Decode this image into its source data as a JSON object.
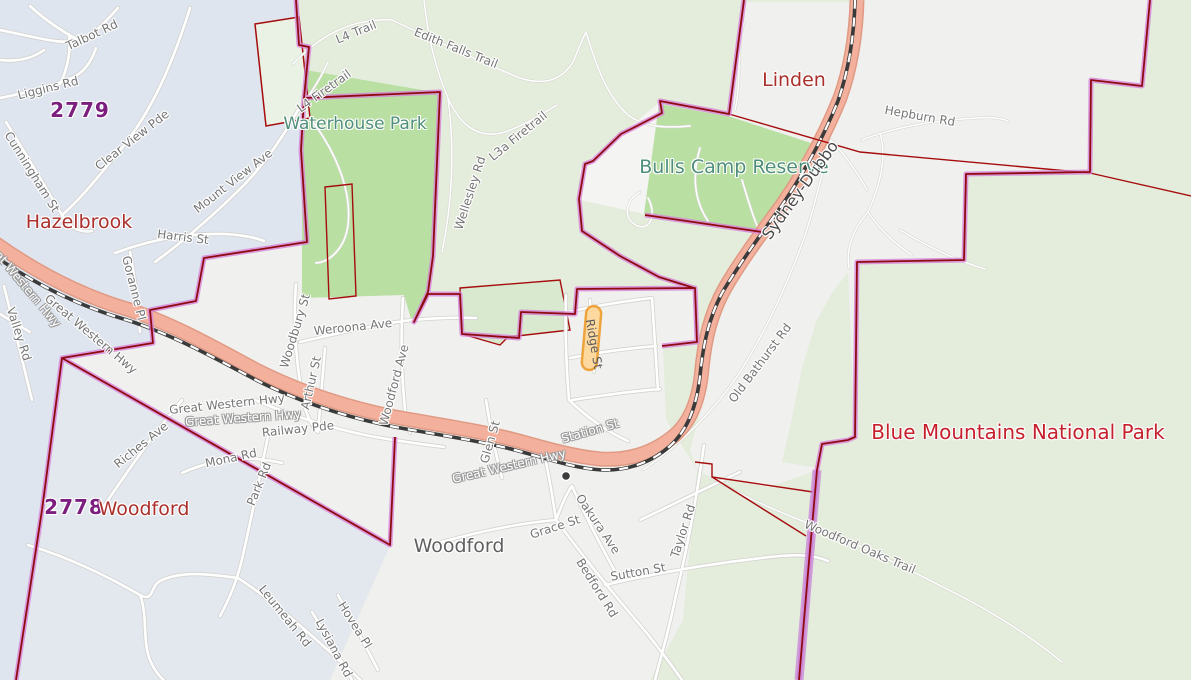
{
  "map": {
    "type": "street-map",
    "region": "Blue Mountains NSW",
    "colors": {
      "bushland_fill": "#e4ecdc",
      "suburb_fill": "#f0f0ee",
      "hazelbrook_fill": "#dfe5ee",
      "park_fill": "#b9dfa2",
      "reserve_fill": "#d8e9cf",
      "parcel_fill": "#eaf2e6",
      "highway_fill": "#f3b19d",
      "highway_casing": "#e09a84",
      "road_fill": "#ffffff",
      "road_casing": "#d2d2cf",
      "railway_dark": "#3a3a3a",
      "boundary_core": "#8e0b10",
      "boundary_glow": "#d783d8",
      "cadastral_red": "#a50d0d",
      "ridge_highlight_fill": "#fdd9a0",
      "ridge_highlight_stroke": "#eda43c",
      "suburb_label": "#ab2f2b",
      "postcode_label": "#7b1e7e",
      "park_label": "#4f8f7a",
      "national_park_label": "#c5202c",
      "road_label": "#757575"
    },
    "icons": {
      "railway_station": "railway-station-icon"
    }
  },
  "labels": [
    {
      "text": "Talbot Rd",
      "kind": "road"
    },
    {
      "text": "Liggins Rd",
      "kind": "road"
    },
    {
      "text": "2779",
      "kind": "postcode"
    },
    {
      "text": "Cunningham St",
      "kind": "road"
    },
    {
      "text": "Clear View Pde",
      "kind": "road"
    },
    {
      "text": "Hazelbrook",
      "kind": "suburb"
    },
    {
      "text": "Harris St",
      "kind": "road"
    },
    {
      "text": "Mount View Ave",
      "kind": "road"
    },
    {
      "text": "Goranne Pl",
      "kind": "road"
    },
    {
      "text": "Valley Rd",
      "kind": "road"
    },
    {
      "text": "Great Western Hwy",
      "kind": "highway"
    },
    {
      "text": "Great Western Hwy",
      "kind": "road"
    },
    {
      "text": "L4 Trail",
      "kind": "trail"
    },
    {
      "text": "Edith Falls Trail",
      "kind": "trail"
    },
    {
      "text": "L4 Firetrail",
      "kind": "trail"
    },
    {
      "text": "Waterhouse Park",
      "kind": "park"
    },
    {
      "text": "Wellesley Rd",
      "kind": "road"
    },
    {
      "text": "L3a Firetrail",
      "kind": "trail"
    },
    {
      "text": "Linden",
      "kind": "suburb"
    },
    {
      "text": "Bulls Camp Reserve",
      "kind": "park"
    },
    {
      "text": "Sydney-Dubbo",
      "kind": "railway"
    },
    {
      "text": "Hepburn Rd",
      "kind": "road"
    },
    {
      "text": "Blue Mountains National Park",
      "kind": "national-park"
    },
    {
      "text": "2778",
      "kind": "postcode"
    },
    {
      "text": "Woodford",
      "kind": "suburb"
    },
    {
      "text": "Woodford",
      "kind": "locality"
    },
    {
      "text": "Woodbury St",
      "kind": "road"
    },
    {
      "text": "Weroona Ave",
      "kind": "road"
    },
    {
      "text": "Arthur St",
      "kind": "road"
    },
    {
      "text": "Woodford Ave",
      "kind": "road"
    },
    {
      "text": "Railway Pde",
      "kind": "road"
    },
    {
      "text": "Great Western Hwy",
      "kind": "road"
    },
    {
      "text": "Great Western Hwy",
      "kind": "highway"
    },
    {
      "text": "Great Western Hwy",
      "kind": "highway"
    },
    {
      "text": "Station St",
      "kind": "highway"
    },
    {
      "text": "Ridge St",
      "kind": "highlighted-road"
    },
    {
      "text": "Glen St",
      "kind": "road"
    },
    {
      "text": "Old Bathurst Rd",
      "kind": "road"
    },
    {
      "text": "Oakura Ave",
      "kind": "road"
    },
    {
      "text": "Grace St",
      "kind": "road"
    },
    {
      "text": "Sutton St",
      "kind": "road"
    },
    {
      "text": "Bedford Rd",
      "kind": "road"
    },
    {
      "text": "Taylor Rd",
      "kind": "road"
    },
    {
      "text": "Leumeah Rd",
      "kind": "road"
    },
    {
      "text": "Hovea Pl",
      "kind": "road"
    },
    {
      "text": "Lysiana Rd",
      "kind": "road"
    },
    {
      "text": "Mona Rd",
      "kind": "road"
    },
    {
      "text": "Park Rd",
      "kind": "road"
    },
    {
      "text": "Riches Ave",
      "kind": "road"
    },
    {
      "text": "Woodford Oaks Trail",
      "kind": "trail"
    }
  ]
}
